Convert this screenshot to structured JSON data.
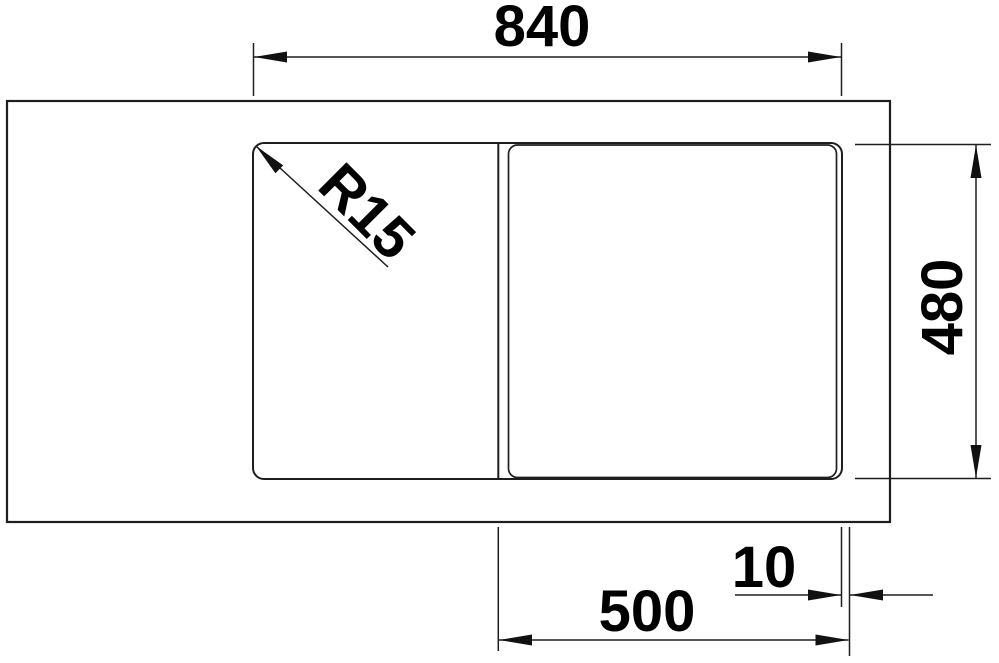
{
  "labels": {
    "overall_width": "840",
    "overall_depth": "480",
    "bowl_width": "500",
    "edge_offset": "10",
    "corner_radius": "R15"
  },
  "colors": {
    "line": "#1e1e1e",
    "text": "#000000",
    "background": "#ffffff"
  }
}
